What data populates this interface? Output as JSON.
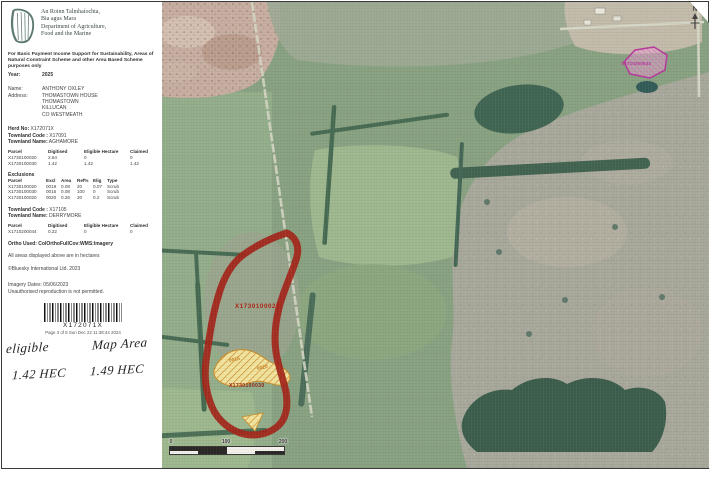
{
  "colors": {
    "parcel_red": "#a11b10",
    "parcel_label_red": "#b01708",
    "exclusion_fill": "#f3e69e",
    "exclusion_hatch": "#d08a25",
    "exclusion_label_orange": "#c87d1e",
    "neighbour_magenta": "#b52f9b",
    "harp_green": "#5c7a70"
  },
  "agency": {
    "irish1": "An Roinn Talmhaíochta,",
    "irish2": "Bia agus Mara",
    "english1": "Department of Agriculture,",
    "english2": "Food and the Marine"
  },
  "intro": {
    "purpose": "For Basic Payment Income Support for Sustainability, Areas of Natural Constraint Scheme and other Area Based Scheme purposes only",
    "year_label": "Year:",
    "year": "2025"
  },
  "applicant": {
    "name_label": "Name:",
    "name": "ANTHONY OXLEY",
    "address_label": "Address:",
    "address1": "THOMASTOWN HOUSE",
    "address2": "THOMASTOWN",
    "address3": "KILLUCAN",
    "address4": "CO WESTMEATH"
  },
  "herd": {
    "label": "Herd No:",
    "value": "X172071X"
  },
  "townland1": {
    "code_label": "Townland Code :",
    "code": "X17091",
    "name_label": "Townland Name:",
    "name": "AGHAMORE"
  },
  "parcels1": {
    "headers": [
      "Parcel",
      "Digitised",
      "Eligible Hectare",
      "Claimed"
    ],
    "rows": [
      [
        "X1730100020",
        "2.64",
        "0",
        "0"
      ],
      [
        "X1730100030",
        "1.42",
        "1.42",
        "1.42"
      ]
    ]
  },
  "exclusions": {
    "title": "Exclusions",
    "headers": [
      "Parcel",
      "Excl",
      "Area",
      "Ref%",
      "Elig",
      "Type"
    ],
    "rows": [
      [
        "X1730100020",
        "0019",
        "0.08",
        "20",
        "0.07",
        "Scrub"
      ],
      [
        "X1730100030",
        "0015",
        "0.08",
        "100",
        "0",
        "Scrub"
      ],
      [
        "X1730100020",
        "0020",
        "0.26",
        "20",
        "0.2",
        "Scrub"
      ]
    ]
  },
  "townland2": {
    "code_label": "Townland Code :",
    "code": "X17105",
    "name_label": "Townland Name:",
    "name": "DERRYMORE"
  },
  "parcels2": {
    "headers": [
      "Parcel",
      "Digitised",
      "Eligible Hectare",
      "Claimed"
    ],
    "rows": [
      [
        "X1710200044",
        "0.22",
        "0",
        "0"
      ]
    ]
  },
  "notes": {
    "ortho": "Ortho Used: ColOrthoFullCov:WMS:Imagery",
    "areas": "All areas displayed above are in hectares",
    "copyright": "©Bluesky International Ltd. 2023",
    "imagery_dates": "Imagery Dates: 05/06/2023",
    "no_repro": "Unauthorised reproduction is not permitted."
  },
  "barcode": {
    "value": "X172071X",
    "page_line": "Page 3 of 5 Sun Dec 22 11:38:44 2024"
  },
  "handwriting": {
    "w1": "eligible",
    "w2": "Map Area",
    "w3": "1.42 HEC",
    "w4": "1.49 HEC"
  },
  "map": {
    "parcel_label_main": "X1730100020",
    "parcel_label_sub": "X1730100030",
    "excl_label_1": "0015",
    "excl_label_2": "0020",
    "neighbour_label": "X1710200044",
    "north": "N",
    "scale": {
      "t0": "0",
      "t1": "100",
      "t2": "200"
    }
  }
}
